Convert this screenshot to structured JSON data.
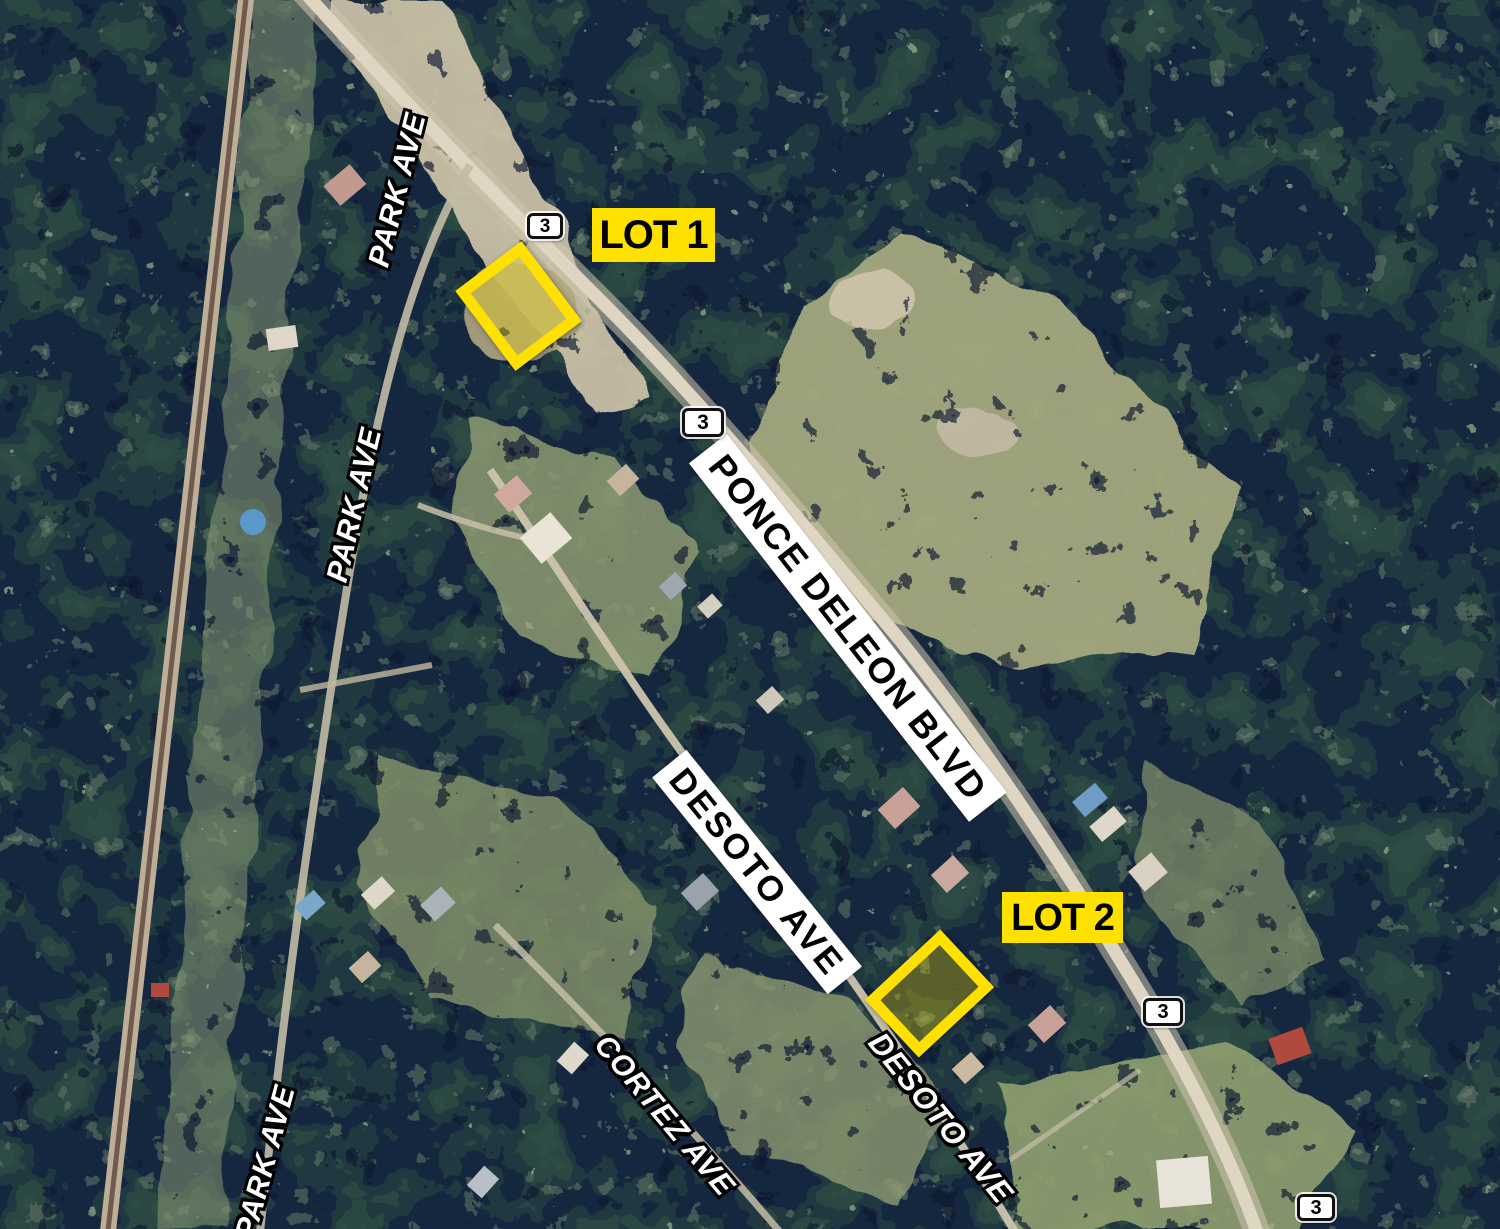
{
  "page": {
    "title": "Aerial lot location map",
    "width_px": 1500,
    "height_px": 1229
  },
  "lots": {
    "lot1": {
      "label": "LOT 1"
    },
    "lot2": {
      "label": "LOT 2"
    }
  },
  "route_shield": {
    "number": "3"
  },
  "streets": {
    "ponce_deleon_blvd": "PONCE DELEON BLVD",
    "desoto_ave_banner": "DESOTO AVE",
    "desoto_ave_outlined": "DESOTO AVE",
    "park_ave_top": "PARK AVE",
    "park_ave_middle": "PARK AVE",
    "park_ave_bottom": "PARK AVE",
    "cortez_ave": "CORTEZ AVE"
  },
  "colors": {
    "highlight_yellow": "#FFE100",
    "label_text_black": "#000000",
    "banner_white": "#FFFFFF",
    "street_text_white": "#FFFFFF",
    "street_text_outline": "#000000"
  }
}
